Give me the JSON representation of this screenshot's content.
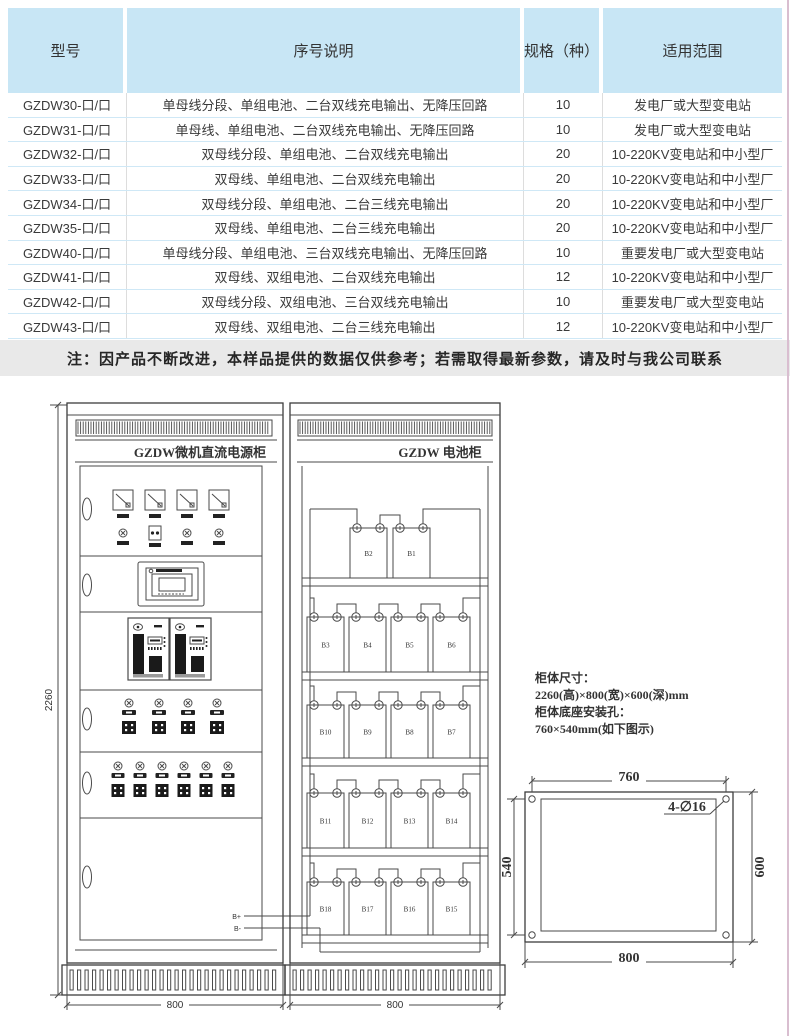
{
  "table": {
    "headers": [
      "型号",
      "序号说明",
      "规格（种）",
      "适用范围"
    ],
    "rows": [
      [
        "GZDW30-口/口",
        "单母线分段、单组电池、二台双线充电输出、无降压回路",
        "10",
        "发电厂或大型变电站"
      ],
      [
        "GZDW31-口/口",
        "单母线、单组电池、二台双线充电输出、无降压回路",
        "10",
        "发电厂或大型变电站"
      ],
      [
        "GZDW32-口/口",
        "双母线分段、单组电池、二台双线充电输出",
        "20",
        "10-220KV变电站和中小型厂"
      ],
      [
        "GZDW33-口/口",
        "双母线、单组电池、二台双线充电输出",
        "20",
        "10-220KV变电站和中小型厂"
      ],
      [
        "GZDW34-口/口",
        "双母线分段、单组电池、二台三线充电输出",
        "20",
        "10-220KV变电站和中小型厂"
      ],
      [
        "GZDW35-口/口",
        "双母线、单组电池、二台三线充电输出",
        "20",
        "10-220KV变电站和中小型厂"
      ],
      [
        "GZDW40-口/口",
        "单母线分段、单组电池、三台双线充电输出、无降压回路",
        "10",
        "重要发电厂或大型变电站"
      ],
      [
        "GZDW41-口/口",
        "双母线、双组电池、二台双线充电输出",
        "12",
        "10-220KV变电站和中小型厂"
      ],
      [
        "GZDW42-口/口",
        "双母线分段、双组电池、三台双线充电输出",
        "10",
        "重要发电厂或大型变电站"
      ],
      [
        "GZDW43-口/口",
        "双母线、双组电池、二台三线充电输出",
        "12",
        "10-220KV变电站和中小型厂"
      ]
    ]
  },
  "note": "注：因产品不断改进，本样品提供的数据仅供参考；若需取得最新参数，请及时与我公司联系",
  "diagram": {
    "power_cabinet_title": "GZDW微机直流电源柜",
    "battery_cabinet_title": "GZDW 电池柜",
    "cabinet_height_dim": "2260",
    "cabinet_width_dim": "800",
    "terminal_positive": "B+",
    "terminal_negative": "B-",
    "battery_shelves": [
      [
        "B2",
        "B1"
      ],
      [
        "B3",
        "B4",
        "B5",
        "B6"
      ],
      [
        "B10",
        "B9",
        "B8",
        "B7"
      ],
      [
        "B11",
        "B12",
        "B13",
        "B14"
      ],
      [
        "B18",
        "B17",
        "B16",
        "B15"
      ]
    ],
    "spec_lines": [
      "柜体尺寸：",
      "2260(高)×800(宽)×600(深)mm",
      "柜体底座安装孔：",
      "760×540mm(如下图示)"
    ],
    "mount": {
      "top_dim": "760",
      "left_dim": "540",
      "right_dim": "600",
      "bottom_dim": "800",
      "hole_label": "4-∅16"
    }
  },
  "colors": {
    "header_blue": "#c8e6f5",
    "row_border_blue": "#cfe8f6",
    "note_gray": "#e9e9e9",
    "line_gray": "#4a4a4a",
    "edge_pink": "#d9bed0"
  }
}
